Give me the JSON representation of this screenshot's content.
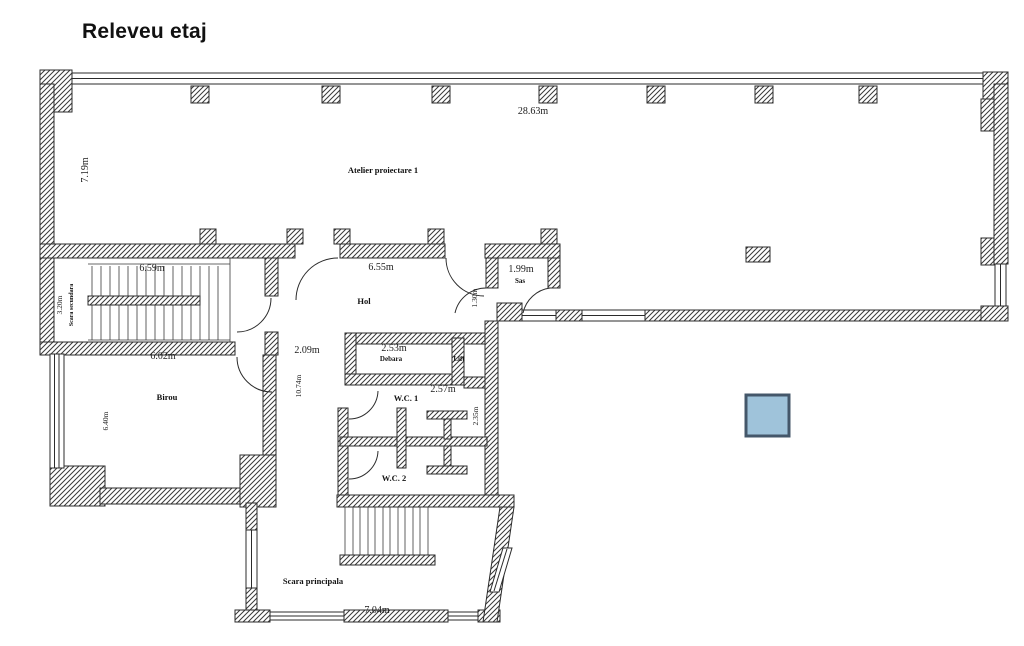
{
  "title": "Releveu etaj",
  "plan": {
    "rooms": {
      "atelier": "Atelier proiectare 1",
      "hol": "Hol",
      "sas": "Sas",
      "debara": "Debara",
      "lift": "Lift",
      "wc1": "W.C. 1",
      "wc2": "W.C. 2",
      "birou": "Birou",
      "scara_secundara": "Scara secundara",
      "scara_principala": "Scara principala"
    },
    "dimensions": {
      "atelier_width": "28.63m",
      "atelier_height": "7.19m",
      "hol_width": "6.55m",
      "sas_width": "1.99m",
      "sas_door": "1.30m",
      "stairs_top": "6.59m",
      "stairs_width": "3.20m",
      "birou_width": "6.02m",
      "birou_height": "6.40m",
      "corridor_width": "2.09m",
      "corridor_length": "10.74m",
      "debara_width": "2.53m",
      "lift_width": "2.57m",
      "wc_width": "2.35m",
      "scara_width": "7.04m"
    },
    "colors": {
      "line": "#2b2b2b",
      "marker_fill": "#9fc3da",
      "marker_border": "#44576a"
    }
  }
}
